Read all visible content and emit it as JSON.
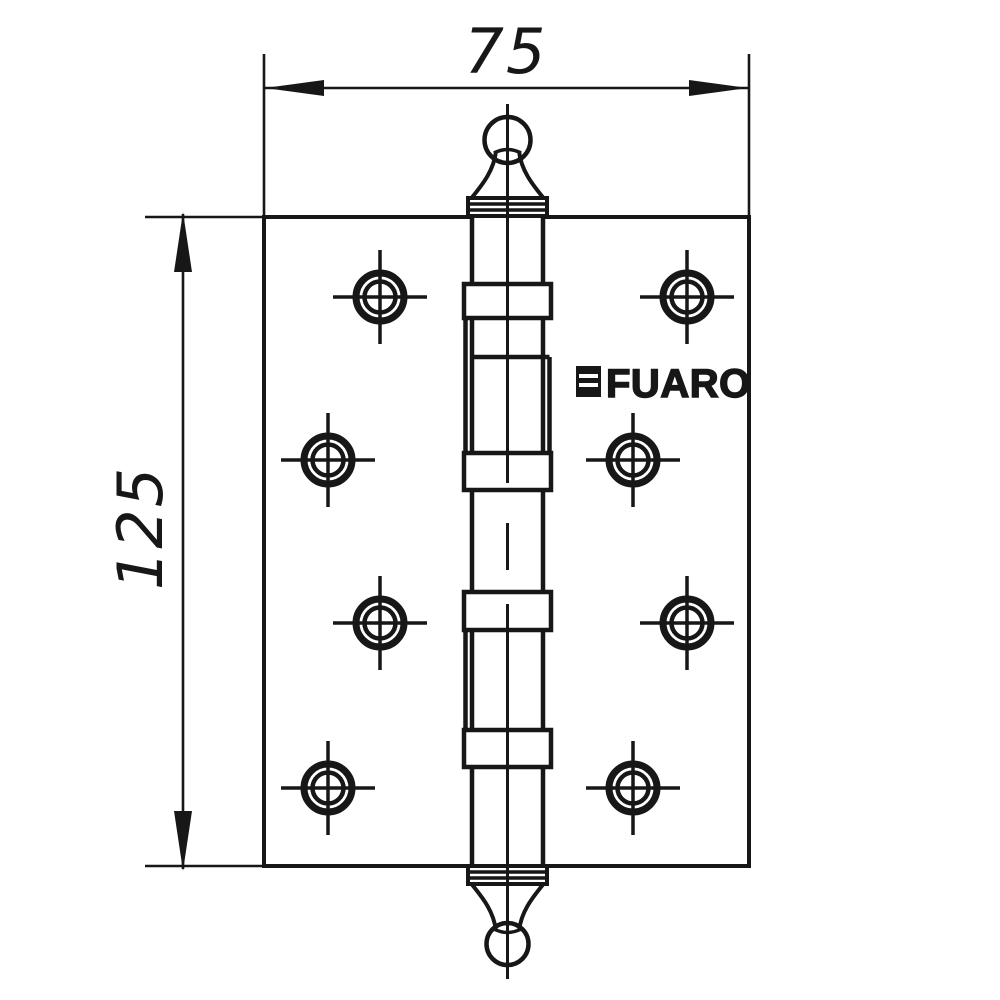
{
  "canvas": {
    "background": "#ffffff",
    "line_color": "#171717"
  },
  "dimensions": {
    "width_label": "75",
    "height_label": "125"
  },
  "brand": {
    "logo_text": "FUARO"
  },
  "symbols": {
    "screw_hole_icon": "crosshair-target-circle",
    "screw_hole_count": 8,
    "top_finial_icon": "ball-crown-finial",
    "bottom_finial_icon": "ball-crown-finial",
    "logo_mark_icon": "fuaro-square-mark"
  }
}
